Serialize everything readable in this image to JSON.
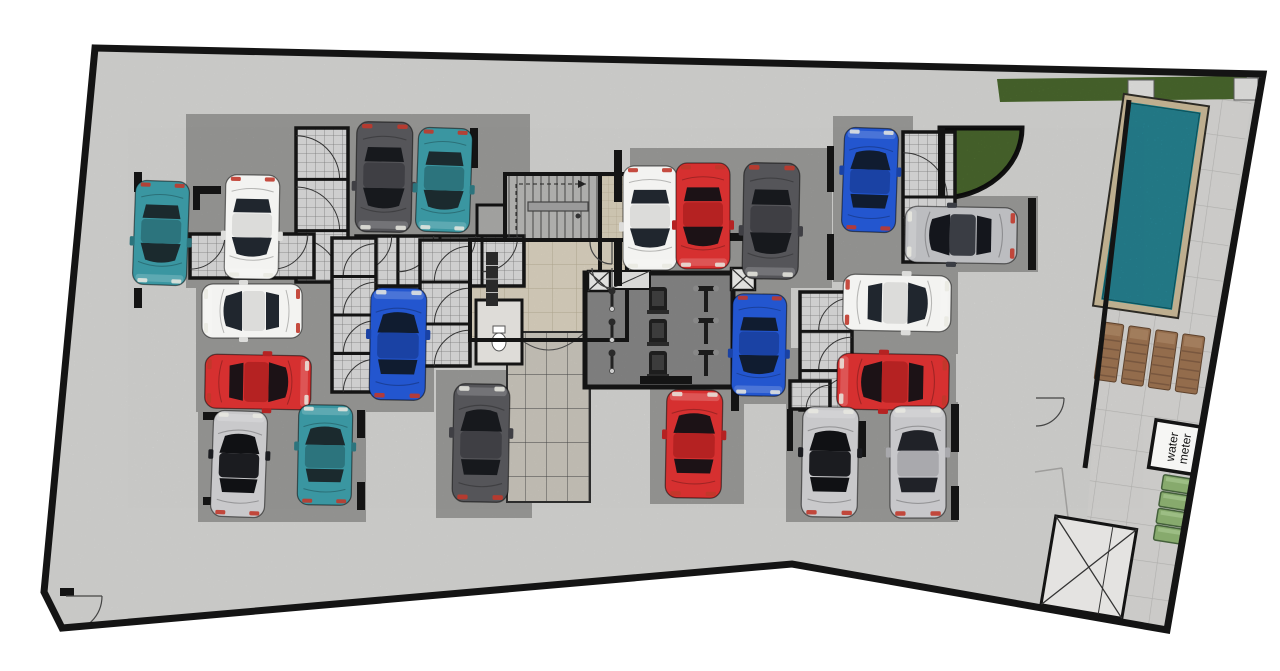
{
  "title": "Basement floor plan – parking garage with gym and pool",
  "labels": {
    "water_meter_line1": "water",
    "water_meter_line2": "meter"
  },
  "palette": {
    "wall": "#141414",
    "concrete": "#e4e4e2",
    "pad": "#a5a5a3",
    "storage_floor": "#cecece",
    "beige_tile": "#eae1cd",
    "ramp_floor": "#d8d4ca",
    "gym_floor": "#8f8f8f",
    "deck_tile": "#e7e6e4",
    "grass": "#6f9c44",
    "pool_water": "#3dd1e9",
    "pool_coping": "#d9c7a3",
    "chair_brown": "#a87c57",
    "meter_green": "#87aa6d"
  },
  "plan": {
    "width": 1280,
    "height": 671,
    "outline": [
      [
        95,
        48
      ],
      [
        1263,
        74
      ],
      [
        1167,
        630
      ],
      [
        792,
        564
      ],
      [
        62,
        628
      ],
      [
        44,
        592
      ]
    ],
    "pool_wall": [
      [
        1129,
        100
      ],
      [
        1097,
        380
      ],
      [
        1085,
        468
      ]
    ],
    "pads": [
      [
        186,
        114,
        344,
        174
      ],
      [
        196,
        280,
        238,
        132
      ],
      [
        198,
        350,
        168,
        172
      ],
      [
        436,
        370,
        96,
        148
      ],
      [
        630,
        148,
        202,
        140
      ],
      [
        833,
        116,
        80,
        166
      ],
      [
        896,
        196,
        142,
        76
      ],
      [
        733,
        280,
        58,
        124
      ],
      [
        845,
        268,
        113,
        86
      ],
      [
        788,
        348,
        168,
        64
      ],
      [
        650,
        382,
        94,
        122
      ],
      [
        786,
        402,
        172,
        120
      ]
    ],
    "storage_blocks": [
      {
        "x": 296,
        "y": 128,
        "w": 52,
        "h": 154,
        "units": 3,
        "dir": "L"
      },
      {
        "x": 356,
        "y": 236,
        "w": 168,
        "h": 50,
        "units": 4,
        "dir": "D"
      },
      {
        "x": 190,
        "y": 234,
        "w": 124,
        "h": 44,
        "units": 3,
        "dir": "D"
      },
      {
        "x": 332,
        "y": 238,
        "w": 44,
        "h": 154,
        "units": 4,
        "dir": "R"
      },
      {
        "x": 420,
        "y": 240,
        "w": 50,
        "h": 126,
        "units": 3,
        "dir": "R"
      },
      {
        "x": 903,
        "y": 132,
        "w": 52,
        "h": 130,
        "units": 2,
        "dir": "L"
      },
      {
        "x": 800,
        "y": 292,
        "w": 52,
        "h": 118,
        "units": 3,
        "dir": "R"
      },
      {
        "x": 790,
        "y": 381,
        "w": 40,
        "h": 28,
        "units": 1,
        "dir": "R"
      }
    ],
    "wc_room": {
      "x": 476,
      "y": 300,
      "w": 46,
      "h": 64,
      "toilet_x": 499,
      "toilet_y": 342
    },
    "shaft_column": {
      "x": 486,
      "y": 252,
      "w": 12,
      "h": 54
    },
    "stairs": {
      "x": 505,
      "y": 174,
      "w": 95,
      "h": 66,
      "landing": [
        528,
        202,
        60,
        9
      ],
      "dash": [
        516,
        230,
        516,
        184,
        586,
        184
      ],
      "dot": [
        578,
        216
      ]
    },
    "small_room": {
      "x": 477,
      "y": 205,
      "w": 28,
      "h": 35
    },
    "elevator": {
      "x": 600,
      "y": 174,
      "w": 27,
      "h": 112
    },
    "lobby": {
      "x": 470,
      "y": 240,
      "w": 157,
      "h": 100
    },
    "ramp": {
      "x": 507,
      "y": 332,
      "w": 83,
      "h": 170
    },
    "gym": {
      "x": 585,
      "y": 273,
      "w": 148,
      "h": 114,
      "bikes": [
        [
          612,
          300
        ],
        [
          612,
          331
        ],
        [
          612,
          362
        ]
      ],
      "treadmills": [
        [
          658,
          300
        ],
        [
          658,
          332
        ],
        [
          658,
          364
        ]
      ],
      "benches": [
        [
          706,
          300
        ],
        [
          706,
          332
        ],
        [
          706,
          364
        ]
      ],
      "xboxes": [
        [
          588,
          271,
          22,
          20
        ],
        [
          731,
          268,
          24,
          22
        ]
      ],
      "hatch_strip": [
        610,
        271,
        40,
        18
      ]
    },
    "planter": "M940,128 L1022,128 A82,70 0 0 1 940,198 Z",
    "grass_strip": [
      [
        997,
        79
      ],
      [
        1247,
        76
      ],
      [
        1243,
        99
      ],
      [
        1000,
        102
      ]
    ],
    "deck": [
      [
        1129,
        101
      ],
      [
        1252,
        98
      ],
      [
        1167,
        628
      ],
      [
        1080,
        617
      ],
      [
        1097,
        380
      ]
    ],
    "pool": {
      "cx": 1151,
      "cy": 206,
      "rot": 8.3,
      "coping": [
        1108,
        99,
        86,
        214
      ],
      "water": [
        1116,
        107,
        70,
        198
      ]
    },
    "pool_pads": [
      [
        1128,
        80,
        26,
        24
      ],
      [
        1234,
        78,
        24,
        22
      ]
    ],
    "chairs": [
      [
        1109,
        352
      ],
      [
        1136,
        356
      ],
      [
        1163,
        360
      ],
      [
        1190,
        364
      ]
    ],
    "chair_rot": 8,
    "meter_room": {
      "x": 1152,
      "y": 424,
      "w": 56,
      "h": 48,
      "rot": 9,
      "cx": 1180,
      "cy": 448
    },
    "green_boxes": {
      "x": 1158,
      "w": 34,
      "h": 15,
      "ys": [
        477,
        494,
        511,
        528
      ],
      "rot": 9,
      "cx": 1176,
      "cy": 512
    },
    "x_room": {
      "x": 1048,
      "y": 522,
      "w": 82,
      "h": 90,
      "rot": 9.5,
      "cx": 1088,
      "cy": 566,
      "divider": 1106
    },
    "deck_lines": [
      [
        1062,
        468,
        1080,
        616
      ],
      [
        1035,
        472,
        1062,
        468
      ]
    ],
    "stub_walls": [
      [
        193,
        186,
        28,
        8
      ],
      [
        193,
        194,
        7,
        16
      ],
      [
        134,
        172,
        8,
        20
      ],
      [
        134,
        288,
        8,
        20
      ],
      [
        614,
        150,
        8,
        52
      ],
      [
        614,
        240,
        8,
        46
      ],
      [
        726,
        233,
        22,
        8
      ],
      [
        827,
        146,
        7,
        46
      ],
      [
        827,
        234,
        7,
        46
      ],
      [
        640,
        376,
        52,
        8
      ],
      [
        731,
        377,
        8,
        34
      ],
      [
        787,
        409,
        6,
        42
      ],
      [
        858,
        421,
        8,
        36
      ],
      [
        899,
        414,
        38,
        8
      ],
      [
        951,
        404,
        8,
        48
      ],
      [
        951,
        486,
        8,
        34
      ],
      [
        203,
        412,
        16,
        8
      ],
      [
        203,
        497,
        16,
        8
      ],
      [
        357,
        410,
        8,
        28
      ],
      [
        357,
        482,
        8,
        28
      ],
      [
        1028,
        198,
        8,
        72
      ],
      [
        938,
        128,
        7,
        70
      ],
      [
        470,
        128,
        8,
        40
      ],
      [
        60,
        588,
        14,
        8
      ]
    ],
    "door_arcs": [
      [
        66,
        596,
        36,
        0,
        90
      ],
      [
        1036,
        398,
        28,
        0,
        90
      ],
      [
        612,
        242,
        22,
        90,
        180
      ],
      [
        612,
        268,
        20,
        90,
        180
      ]
    ],
    "car_colors": {
      "white": {
        "body": "#f3f3f1",
        "roof": "#dcdcda",
        "glass": "#20262e"
      },
      "teal": {
        "body": "#3a96a1",
        "roof": "#2c747d",
        "glass": "#1b2a2e"
      },
      "darkgray": {
        "body": "#555559",
        "roof": "#3f3f44",
        "glass": "#17191d"
      },
      "blue": {
        "body": "#2356cf",
        "roof": "#1a42a4",
        "glass": "#101c30"
      },
      "red": {
        "body": "#d63030",
        "roof": "#b52222",
        "glass": "#1c1216"
      },
      "silver": {
        "body": "#c7c7ca",
        "roof": "#a9a9ad",
        "glass": "#202228"
      },
      "silverdark": {
        "body": "#bcbdc0",
        "roof": "#3a3d44",
        "glass": "#14161c"
      },
      "blacksilver": {
        "body": "#c9c9cb",
        "roof": "#1b1c20",
        "glass": "#101114"
      }
    },
    "cars": [
      {
        "x": 161,
        "y": 233,
        "rot": 2,
        "color": "teal",
        "len": 104
      },
      {
        "x": 252,
        "y": 227,
        "rot": 1,
        "color": "white",
        "len": 104
      },
      {
        "x": 384,
        "y": 177,
        "rot": 1,
        "color": "darkgray",
        "len": 110
      },
      {
        "x": 444,
        "y": 180,
        "rot": 2,
        "color": "teal",
        "len": 104
      },
      {
        "x": 252,
        "y": 311,
        "rot": 90,
        "color": "white",
        "len": 100
      },
      {
        "x": 398,
        "y": 344,
        "rot": 181,
        "color": "blue",
        "len": 112
      },
      {
        "x": 258,
        "y": 382,
        "rot": -89,
        "color": "red",
        "len": 106
      },
      {
        "x": 239,
        "y": 464,
        "rot": 182,
        "color": "blacksilver",
        "len": 106
      },
      {
        "x": 325,
        "y": 455,
        "rot": 181,
        "color": "teal",
        "len": 100
      },
      {
        "x": 481,
        "y": 443,
        "rot": 181,
        "color": "darkgray",
        "len": 118
      },
      {
        "x": 650,
        "y": 218,
        "rot": 0,
        "color": "white",
        "len": 104
      },
      {
        "x": 703,
        "y": 216,
        "rot": 0,
        "color": "red",
        "len": 106
      },
      {
        "x": 771,
        "y": 221,
        "rot": 1,
        "color": "darkgray",
        "len": 116
      },
      {
        "x": 870,
        "y": 180,
        "rot": 182,
        "color": "blue",
        "len": 104
      },
      {
        "x": 961,
        "y": 235,
        "rot": 91,
        "color": "silverdark",
        "len": 112
      },
      {
        "x": 759,
        "y": 345,
        "rot": 1,
        "color": "blue",
        "len": 102
      },
      {
        "x": 897,
        "y": 303,
        "rot": -89,
        "color": "white",
        "len": 108
      },
      {
        "x": 893,
        "y": 382,
        "rot": 91,
        "color": "red",
        "len": 112
      },
      {
        "x": 694,
        "y": 444,
        "rot": 181,
        "color": "red",
        "len": 108
      },
      {
        "x": 830,
        "y": 462,
        "rot": 181,
        "color": "blacksilver",
        "len": 110
      },
      {
        "x": 918,
        "y": 462,
        "rot": 180,
        "color": "silver",
        "len": 112
      }
    ]
  }
}
